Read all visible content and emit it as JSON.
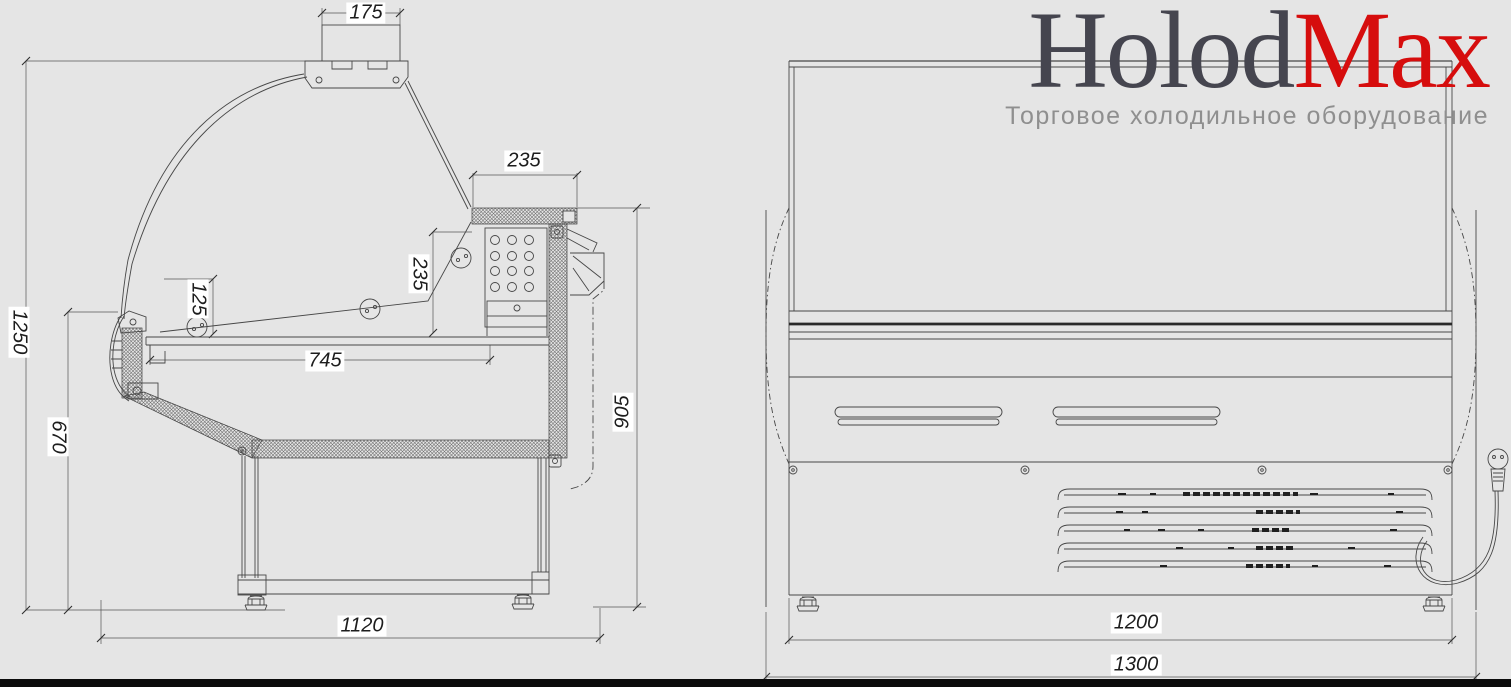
{
  "logo": {
    "name_dark": "Holod",
    "name_red": "Max",
    "tagline": "Торговое холодильное оборудование"
  },
  "colors": {
    "paper": "#e5e5e5",
    "line": "#4a4a4a",
    "thick_line": "#2a2a2a",
    "logo_dark": "#45454f",
    "logo_red": "#d60d0d",
    "tagline_gray": "#8f8f8f",
    "footer_bar": "#0b0b0b",
    "label_bg": "#ffffff"
  },
  "side_view": {
    "dims": {
      "canopy_width": "175",
      "top_shelf_depth": "235",
      "front_glass_rise": "125",
      "shelf_height": "235",
      "deck_depth": "745",
      "rear_height": "905",
      "front_height": "670",
      "overall_height": "1250",
      "base_depth": "1120"
    }
  },
  "front_view": {
    "dims": {
      "body_width": "1200",
      "overall_width": "1300"
    }
  }
}
